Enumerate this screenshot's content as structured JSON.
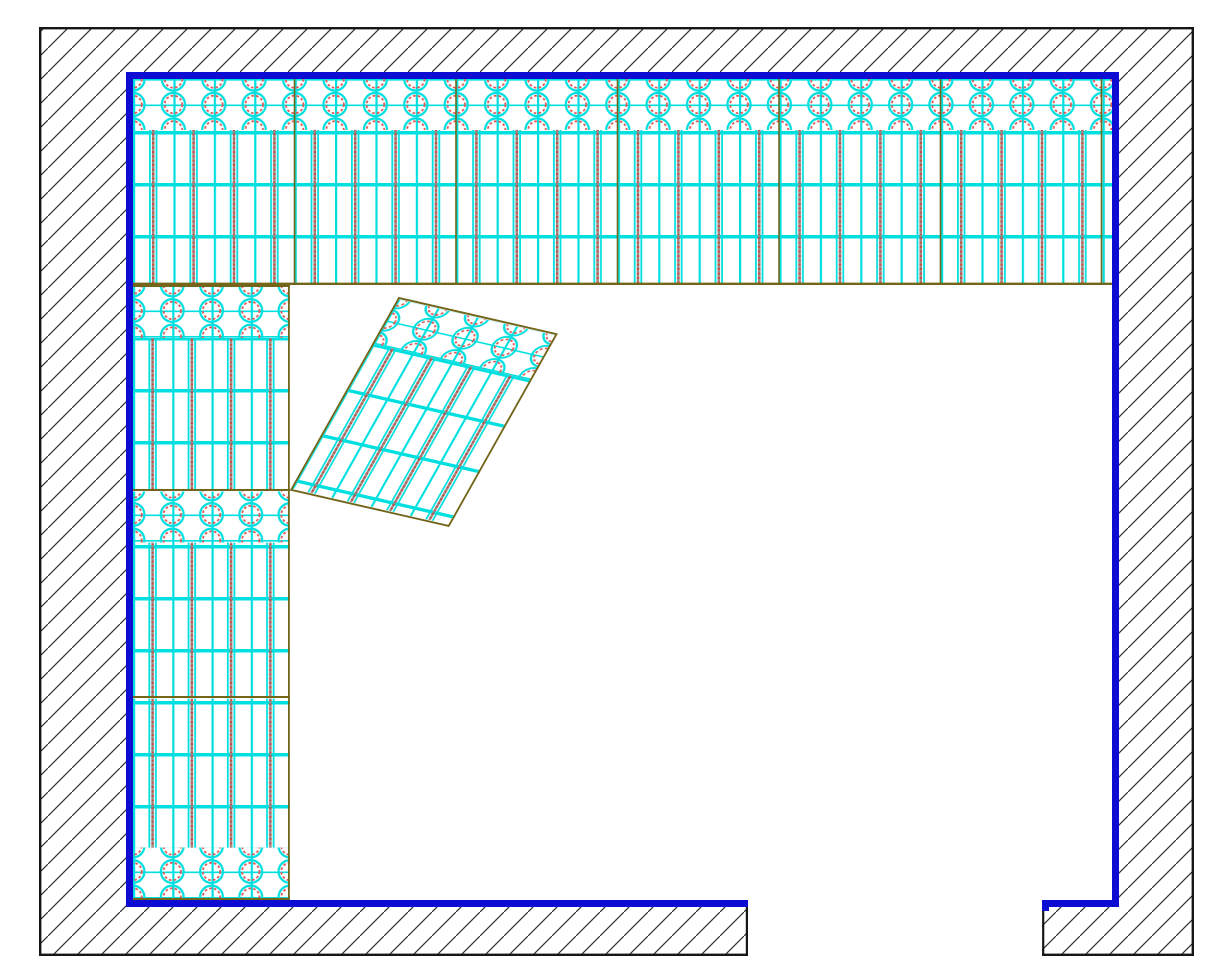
{
  "colors": {
    "background": "#ffffff",
    "boundary_blue": "#0c0cd2",
    "panel_cyan": "#00dfdf",
    "motif_red": "#e05858",
    "seam_olive": "#73651a",
    "outline_black": "#161616",
    "hatch_line": "#303030",
    "stem_gray": "#8f8f8f",
    "stem_red": "#bf4f45"
  },
  "drawing": {
    "canvas": {
      "width_px": 1214,
      "height_px": 971
    },
    "entities": [
      {
        "name": "outer-wall",
        "fill": "diagonal-hatch",
        "outline": "black"
      },
      {
        "name": "room-boundary",
        "stroke": "boundary_blue",
        "open_side": "bottom-center"
      },
      {
        "name": "top-panel-band",
        "pattern": "diamond-grille",
        "diamond_rows": 2,
        "panel_seams": 6
      },
      {
        "name": "left-panel-band",
        "pattern": "diamond-grille",
        "stacked_panels": 3
      },
      {
        "name": "rotated-panel",
        "pattern": "diamond-grille",
        "rotation_deg": 13
      },
      {
        "name": "door-opening",
        "side": "bottom"
      }
    ]
  }
}
